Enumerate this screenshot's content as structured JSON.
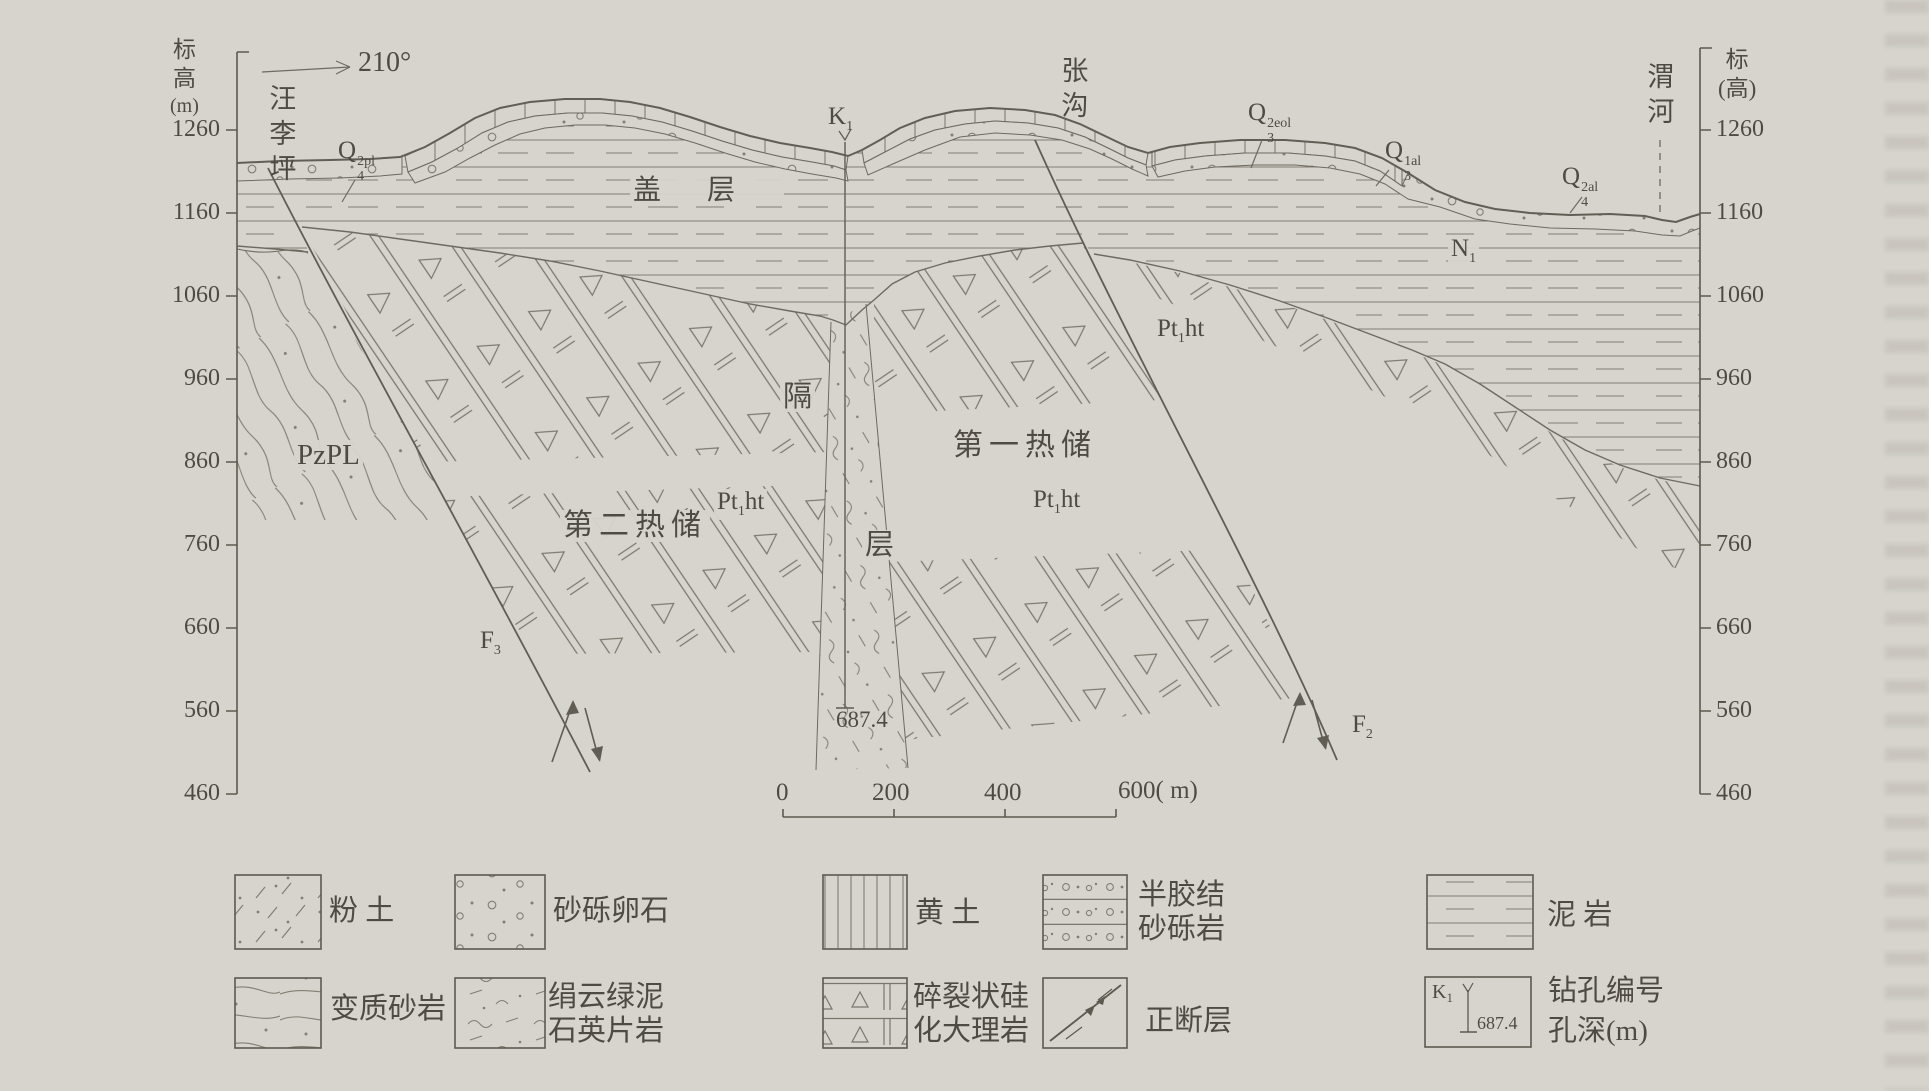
{
  "axes": {
    "left": {
      "title": [
        "标",
        "高",
        "(m)"
      ],
      "ticks": [
        "1260",
        "1160",
        "1060",
        "960",
        "860",
        "760",
        "660",
        "560",
        "460"
      ]
    },
    "right": {
      "title": [
        "标",
        "(高)"
      ],
      "ticks": [
        "1260",
        "1160",
        "1060",
        "960",
        "860",
        "760",
        "660",
        "560",
        "460"
      ]
    }
  },
  "header": {
    "bearing": "210°",
    "place_left": "汪李坪",
    "place_middle": "张沟",
    "place_right": "渭河"
  },
  "section": {
    "q4_2pl": {
      "base": "Q",
      "sub": "4",
      "sup": "2pl"
    },
    "k1": {
      "base": "K",
      "sub": "1"
    },
    "q3_2eol": {
      "base": "Q",
      "sub": "3",
      "sup": "2eol"
    },
    "q3_1al": {
      "base": "Q",
      "sub": "3",
      "sup": "1al"
    },
    "q4_2al": {
      "base": "Q",
      "sub": "4",
      "sup": "2al"
    },
    "n1": {
      "base": "N",
      "sub": "1"
    },
    "pzpl": "PzPL",
    "pt1ht": {
      "base": "Pt",
      "sub": "1",
      "tail": "ht"
    },
    "cover_label": "盖层",
    "aquitard_top": "隔",
    "aquitard_bottom": "层",
    "reservoir_first": "第一热储",
    "reservoir_second": "第二热储",
    "f3": {
      "base": "F",
      "sub": "3"
    },
    "f2": {
      "base": "F",
      "sub": "2"
    },
    "borehole_depth": "687.4"
  },
  "scale_bar": {
    "t0": "0",
    "t200": "200",
    "t400": "400",
    "end_label": "600( m)"
  },
  "legend": {
    "silt": "粉 土",
    "sand_gravel_pebble": "砂砾卵石",
    "loess": "黄 土",
    "semi_cemented_1": "半胶结",
    "semi_cemented_2": "砂砾岩",
    "mudstone": "泥 岩",
    "meta_sandstone": "变质砂岩",
    "schist_1": "绢云绿泥",
    "schist_2": "石英片岩",
    "marble_1": "碎裂状硅",
    "marble_2": "化大理岩",
    "normal_fault": "正断层",
    "borehole_no": "钻孔编号",
    "hole_depth": "孔深(m)",
    "k1_sym": {
      "base": "K",
      "sub": "1",
      "depth": "687.4"
    }
  }
}
